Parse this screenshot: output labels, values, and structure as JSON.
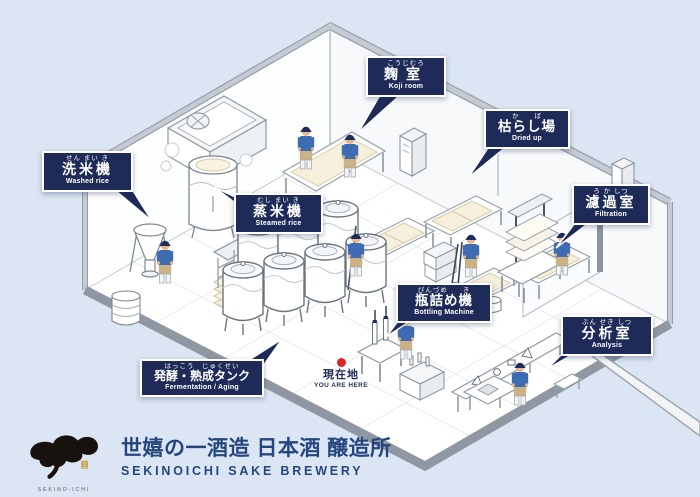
{
  "colors": {
    "background": "#dbe5f3",
    "label_background": "#1e2a57",
    "brand_navy": "#25477d",
    "marker_red": "#d7252b",
    "worker_blue": "#3e6cb3"
  },
  "map": {
    "labels": [
      {
        "id": "washed-rice",
        "furigana": "せん まい き",
        "jp": "洗米機",
        "en": "Washed rice"
      },
      {
        "id": "steamed-rice",
        "furigana": "むし まい き",
        "jp": "蒸米機",
        "en": "Steamed rice"
      },
      {
        "id": "koji-room",
        "furigana": "こうじむろ",
        "jp": "麹室",
        "en": "Koji room"
      },
      {
        "id": "dried-up",
        "furigana": "か　　ば",
        "jp": "枯らし場",
        "en": "Dried up"
      },
      {
        "id": "filtration",
        "furigana": "ろ か しつ",
        "jp": "濾過室",
        "en": "Filtration"
      },
      {
        "id": "bottling-machine",
        "furigana": "びんづめ　　き",
        "jp": "瓶詰め機",
        "en": "Bottling Machine"
      },
      {
        "id": "analysis",
        "furigana": "ぶん せき しつ",
        "jp": "分析室",
        "en": "Analysis"
      },
      {
        "id": "fermentation-aging",
        "furigana": "はっこう　じゅくせい",
        "jp": "発酵・熟成タンク",
        "en": "Fermentation / Aging"
      }
    ],
    "you_are_here": {
      "jp": "現在地",
      "en": "YOU ARE HERE"
    }
  },
  "footer": {
    "logo_caption": "SEKINO-ICHI",
    "title_jp": "世嬉の一酒造 日本酒 醸造所",
    "title_en": "SEKINOICHI SAKE BREWERY"
  }
}
